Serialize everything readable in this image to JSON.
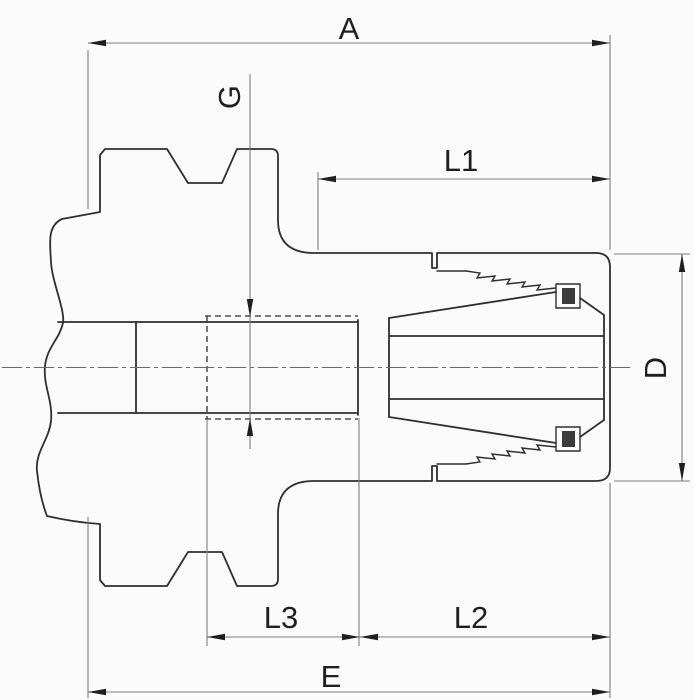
{
  "drawing": {
    "kind": "technical-dimension-drawing",
    "colors": {
      "background": "#fbfbfb",
      "outline": "#2f2f2f",
      "dimension_line": "#7d7d7d",
      "arrow_and_text": "#1f1f1f"
    },
    "dimension_labels": {
      "a": "A",
      "g": "G",
      "l1": "L1",
      "d": "D",
      "l3": "L3",
      "l2": "L2",
      "e": "E"
    }
  }
}
